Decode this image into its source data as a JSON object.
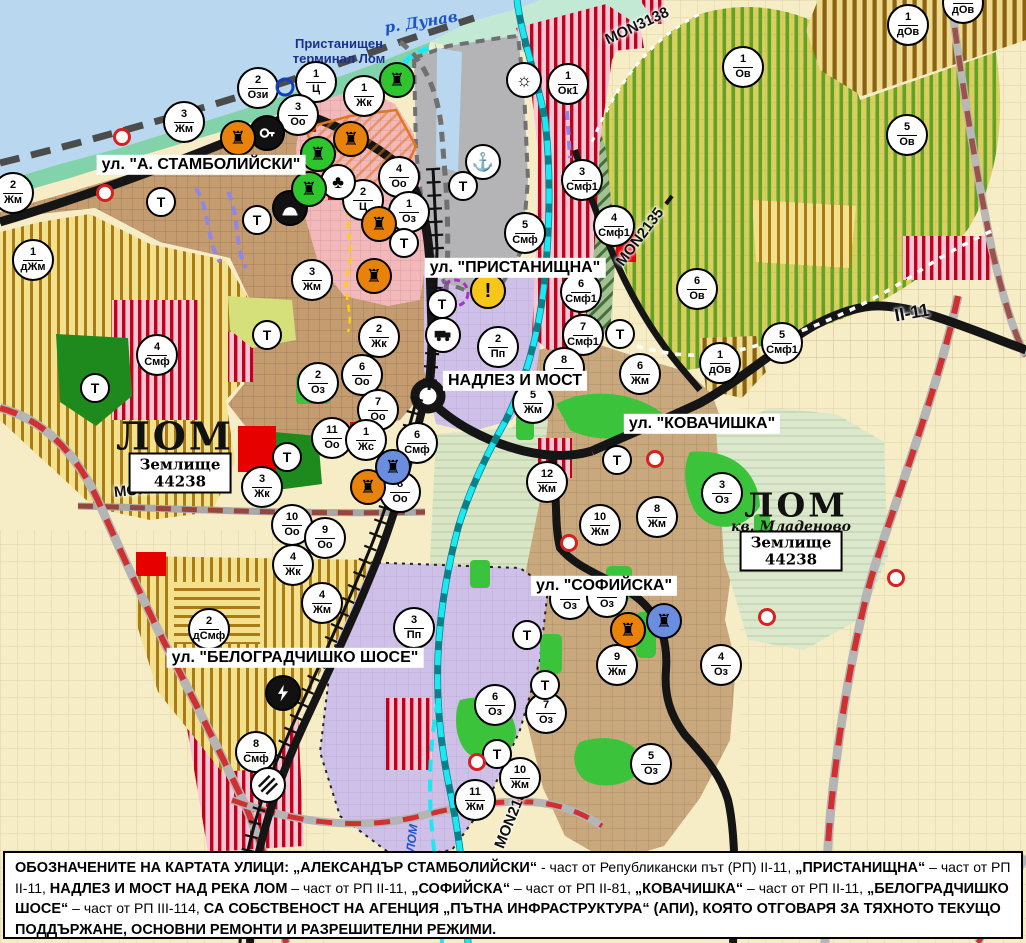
{
  "map": {
    "water": {
      "danube_label": "р. Дунав",
      "lom_river_label": "ЛОМ"
    },
    "places": {
      "port_terminal_line1": "Пристанищен",
      "port_terminal_line2": "терминал Лом",
      "city_left_name": "ЛОМ",
      "city_left_landplot": "Землище",
      "city_left_landplot_code": "44238",
      "city_right_name": "ЛОМ",
      "city_right_district": "кв. Младеново",
      "city_right_landplot": "Землище",
      "city_right_landplot_code": "44238"
    },
    "street_labels": [
      {
        "id": "stambolijski",
        "text": "ул. \"А. СТАМБОЛИЙСКИ\"",
        "x": 201,
        "y": 165
      },
      {
        "id": "pristanishtna",
        "text": "ул. \"ПРИСТАНИЩНА\"",
        "x": 515,
        "y": 268
      },
      {
        "id": "nadlez-i-most",
        "text": "НАДЛЕЗ И МОСТ",
        "x": 515,
        "y": 381
      },
      {
        "id": "kovachishka",
        "text": "ул. \"КОВАЧИШКА\"",
        "x": 702,
        "y": 424
      },
      {
        "id": "sofiyska",
        "text": "ул. \"СОФИЙСКА\"",
        "x": 604,
        "y": 586
      },
      {
        "id": "belogradchishko",
        "text": "ул. \"БЕЛОГРАДЧИШКО ШОСЕ\"",
        "x": 295,
        "y": 658
      }
    ],
    "road_labels": [
      {
        "text": "MON3138",
        "x": 637,
        "y": 26,
        "rot": -25,
        "size": 15
      },
      {
        "text": "MON2135",
        "x": 640,
        "y": 237,
        "rot": -53,
        "size": 15
      },
      {
        "text": "MON3139",
        "x": 148,
        "y": 489,
        "rot": -6,
        "size": 15
      },
      {
        "text": "MON2136",
        "x": 512,
        "y": 816,
        "rot": -68,
        "size": 15
      },
      {
        "text": "II-11",
        "x": 912,
        "y": 313,
        "rot": -10,
        "size": 18
      }
    ],
    "zone_circles": [
      {
        "n": "2",
        "d": "Ози",
        "x": 258,
        "y": 88
      },
      {
        "n": "1",
        "d": "Ц",
        "x": 316,
        "y": 82
      },
      {
        "n": "1",
        "d": "Жк",
        "x": 364,
        "y": 96
      },
      {
        "n": "3",
        "d": "Жм",
        "x": 184,
        "y": 122
      },
      {
        "n": "3",
        "d": "Оо",
        "x": 298,
        "y": 115
      },
      {
        "n": "2",
        "d": "Жм",
        "x": 13,
        "y": 193
      },
      {
        "n": "1",
        "d": "дЖм",
        "x": 33,
        "y": 260
      },
      {
        "n": "4",
        "d": "Оо",
        "x": 399,
        "y": 177
      },
      {
        "n": "2",
        "d": "Ц",
        "x": 363,
        "y": 200
      },
      {
        "n": "1",
        "d": "Оз",
        "x": 409,
        "y": 212
      },
      {
        "n": "3",
        "d": "Жм",
        "x": 312,
        "y": 280
      },
      {
        "n": "5",
        "d": "Смф",
        "x": 525,
        "y": 233
      },
      {
        "n": "1",
        "d": "Ок1",
        "x": 568,
        "y": 84
      },
      {
        "n": "3",
        "d": "Смф1",
        "x": 582,
        "y": 180
      },
      {
        "n": "4",
        "d": "Смф1",
        "x": 614,
        "y": 226
      },
      {
        "n": "6",
        "d": "Смф1",
        "x": 581,
        "y": 292
      },
      {
        "n": "7",
        "d": "Смф1",
        "x": 583,
        "y": 335
      },
      {
        "n": "6",
        "d": "Ов",
        "x": 697,
        "y": 289
      },
      {
        "n": "1",
        "d": "Ов",
        "x": 743,
        "y": 67
      },
      {
        "n": "1",
        "d": "дОв",
        "x": 908,
        "y": 25
      },
      {
        "n": "",
        "d": "дОв",
        "x": 963,
        "y": 3
      },
      {
        "n": "5",
        "d": "Ов",
        "x": 907,
        "y": 135
      },
      {
        "n": "5",
        "d": "Смф1",
        "x": 782,
        "y": 343
      },
      {
        "n": "1",
        "d": "дОв",
        "x": 720,
        "y": 363
      },
      {
        "n": "2",
        "d": "Пп",
        "x": 498,
        "y": 347
      },
      {
        "n": "8",
        "d": "",
        "x": 564,
        "y": 368
      },
      {
        "n": "5",
        "d": "Жм",
        "x": 533,
        "y": 403
      },
      {
        "n": "6",
        "d": "Жм",
        "x": 640,
        "y": 374
      },
      {
        "n": "12",
        "d": "Жм",
        "x": 547,
        "y": 482
      },
      {
        "n": "10",
        "d": "Жм",
        "x": 600,
        "y": 525
      },
      {
        "n": "8",
        "d": "Жм",
        "x": 657,
        "y": 517
      },
      {
        "n": "3",
        "d": "Оз",
        "x": 722,
        "y": 493
      },
      {
        "n": "2",
        "d": "Жк",
        "x": 379,
        "y": 337
      },
      {
        "n": "2",
        "d": "Оз",
        "x": 318,
        "y": 383
      },
      {
        "n": "6",
        "d": "Оо",
        "x": 362,
        "y": 375
      },
      {
        "n": "7",
        "d": "Оо",
        "x": 378,
        "y": 410
      },
      {
        "n": "11",
        "d": "Оо",
        "x": 332,
        "y": 438
      },
      {
        "n": "1",
        "d": "Жс",
        "x": 366,
        "y": 440
      },
      {
        "n": "6",
        "d": "Смф",
        "x": 417,
        "y": 443
      },
      {
        "n": "3",
        "d": "Жк",
        "x": 262,
        "y": 487
      },
      {
        "n": "8",
        "d": "Оо",
        "x": 400,
        "y": 492
      },
      {
        "n": "10",
        "d": "Оо",
        "x": 292,
        "y": 525
      },
      {
        "n": "9",
        "d": "Оо",
        "x": 325,
        "y": 538
      },
      {
        "n": "4",
        "d": "Жк",
        "x": 293,
        "y": 565
      },
      {
        "n": "4",
        "d": "Жм",
        "x": 322,
        "y": 603
      },
      {
        "n": "3",
        "d": "Пп",
        "x": 414,
        "y": 628
      },
      {
        "n": "2",
        "d": "дСмф",
        "x": 209,
        "y": 629
      },
      {
        "n": "8",
        "d": "Смф",
        "x": 256,
        "y": 752
      },
      {
        "n": "4",
        "d": "Смф",
        "x": 157,
        "y": 355
      },
      {
        "n": "9",
        "d": "Жм",
        "x": 617,
        "y": 665
      },
      {
        "n": "4",
        "d": "Оз",
        "x": 721,
        "y": 665
      },
      {
        "n": "6",
        "d": "Оз",
        "x": 495,
        "y": 705
      },
      {
        "n": "7",
        "d": "Оз",
        "x": 546,
        "y": 713
      },
      {
        "n": "5",
        "d": "Оз",
        "x": 651,
        "y": 764
      },
      {
        "n": "10",
        "d": "Жм",
        "x": 520,
        "y": 778
      },
      {
        "n": "11",
        "d": "Жм",
        "x": 475,
        "y": 800
      },
      {
        "n": "",
        "d": "Оз",
        "x": 570,
        "y": 599
      },
      {
        "n": "",
        "d": "Оз",
        "x": 607,
        "y": 597
      }
    ],
    "t_marker_label": "Т",
    "t_circles": [
      [
        161,
        202
      ],
      [
        257,
        220
      ],
      [
        267,
        335
      ],
      [
        95,
        388
      ],
      [
        287,
        457
      ],
      [
        404,
        243
      ],
      [
        442,
        304
      ],
      [
        620,
        334
      ],
      [
        617,
        460
      ],
      [
        527,
        635
      ],
      [
        545,
        685
      ],
      [
        497,
        754
      ],
      [
        463,
        186
      ]
    ],
    "icons": [
      {
        "x": 483,
        "y": 162,
        "type": "anchor",
        "name": "port-anchor-icon"
      },
      {
        "x": 524,
        "y": 80,
        "type": "sun",
        "name": "sun-icon"
      },
      {
        "x": 488,
        "y": 291,
        "type": "warning",
        "name": "warning-icon"
      },
      {
        "x": 443,
        "y": 335,
        "type": "truck",
        "name": "truck-station-icon"
      },
      {
        "x": 267,
        "y": 133,
        "type": "key",
        "name": "key-icon"
      },
      {
        "x": 338,
        "y": 182,
        "type": "trefoil",
        "name": "trefoil-icon"
      },
      {
        "x": 290,
        "y": 208,
        "type": "tunnel",
        "name": "tunnel-icon"
      },
      {
        "x": 283,
        "y": 693,
        "type": "bolt",
        "name": "power-icon"
      },
      {
        "x": 268,
        "y": 785,
        "type": "crossing",
        "name": "railway-crossing-icon"
      },
      {
        "x": 238,
        "y": 138,
        "type": "monument-orange",
        "name": "monument-icon"
      },
      {
        "x": 351,
        "y": 139,
        "type": "monument-orange",
        "name": "monument-icon"
      },
      {
        "x": 379,
        "y": 224,
        "type": "monument-orange",
        "name": "monument-icon"
      },
      {
        "x": 374,
        "y": 276,
        "type": "monument-orange",
        "name": "monument-icon"
      },
      {
        "x": 368,
        "y": 487,
        "type": "monument-orange",
        "name": "monument-icon"
      },
      {
        "x": 628,
        "y": 630,
        "type": "monument-orange",
        "name": "monument-icon"
      },
      {
        "x": 397,
        "y": 80,
        "type": "monument-green",
        "name": "monument-icon"
      },
      {
        "x": 318,
        "y": 154,
        "type": "monument-green",
        "name": "monument-icon"
      },
      {
        "x": 309,
        "y": 189,
        "type": "monument-green",
        "name": "monument-icon"
      },
      {
        "x": 393,
        "y": 467,
        "type": "monument-blue",
        "name": "monument-icon"
      },
      {
        "x": 664,
        "y": 621,
        "type": "monument-blue",
        "name": "monument-icon"
      }
    ],
    "red_dots": [
      [
        122,
        137
      ],
      [
        105,
        193
      ],
      [
        655,
        459
      ],
      [
        569,
        543
      ],
      [
        477,
        762
      ],
      [
        767,
        617
      ],
      [
        896,
        578
      ]
    ],
    "blue_rings": [
      [
        285,
        87
      ]
    ],
    "colors": {
      "water": "#b9d8ef",
      "shore": "#82d2ab",
      "port_area": "#b4b4b6",
      "urban": "#c59c70",
      "vineyard_bg": "#d8d05e",
      "vineyard_stripe": "#61a126",
      "yellow_zone_bg": "#f4e18e",
      "yellow_zone_stripe": "#a87b16",
      "mixed_zone_bg": "#f4c6d6",
      "mixed_zone_stripe": "#c3001a",
      "industrial_purple": "#cfc0ea",
      "terrain_green": "#dce8cc",
      "park_bright": "#3bc43b",
      "park_dark": "#1e8a1e",
      "road_black": "#151515",
      "road_red_dash": "#d03030",
      "river_cyan": "#1ae8f2",
      "label_blue": "#18308f",
      "central_pink": "#f3b9ba",
      "monument_orange": "#e8820a",
      "monument_green": "#2ec52e",
      "monument_blue": "#6b8de0",
      "warning_yellow": "#f6c619"
    },
    "footer_segments": [
      {
        "t": "ОБОЗНАЧЕНИТЕ НА КАРТАТА УЛИЦИ: „АЛЕКСАНДЪР СТАМБОЛИЙСКИ“",
        "b": 1
      },
      {
        "t": " - част от Републикански път (РП) II-11, ",
        "b": 0
      },
      {
        "t": "„ПРИСТАНИЩНА“",
        "b": 1
      },
      {
        "t": " – част от РП II-11, ",
        "b": 0
      },
      {
        "t": "НАДЛЕЗ И МОСТ НАД РЕКА ЛОМ",
        "b": 1
      },
      {
        "t": " – част от РП II-11, ",
        "b": 0
      },
      {
        "t": "„СОФИЙСКА“",
        "b": 1
      },
      {
        "t": " – част от РП II-81, ",
        "b": 0
      },
      {
        "t": "„КОВАЧИШКА“",
        "b": 1
      },
      {
        "t": " – част от РП II-11, ",
        "b": 0
      },
      {
        "t": "„БЕЛОГРАДЧИШКО ШОСЕ“",
        "b": 1
      },
      {
        "t": " – част от РП III-114, ",
        "b": 0
      },
      {
        "t": "СА СОБСТВЕНОСТ НА АГЕНЦИЯ „ПЪТНА ИНФРАСТРУКТУРА“ (АПИ), КОЯТО ОТГОВАРЯ ЗА ТЯХНОТО ТЕКУЩО ПОДДЪРЖАНЕ, ОСНОВНИ РЕМОНТИ И РАЗРЕШИТЕЛНИ РЕЖИМИ.",
        "b": 1
      }
    ]
  }
}
